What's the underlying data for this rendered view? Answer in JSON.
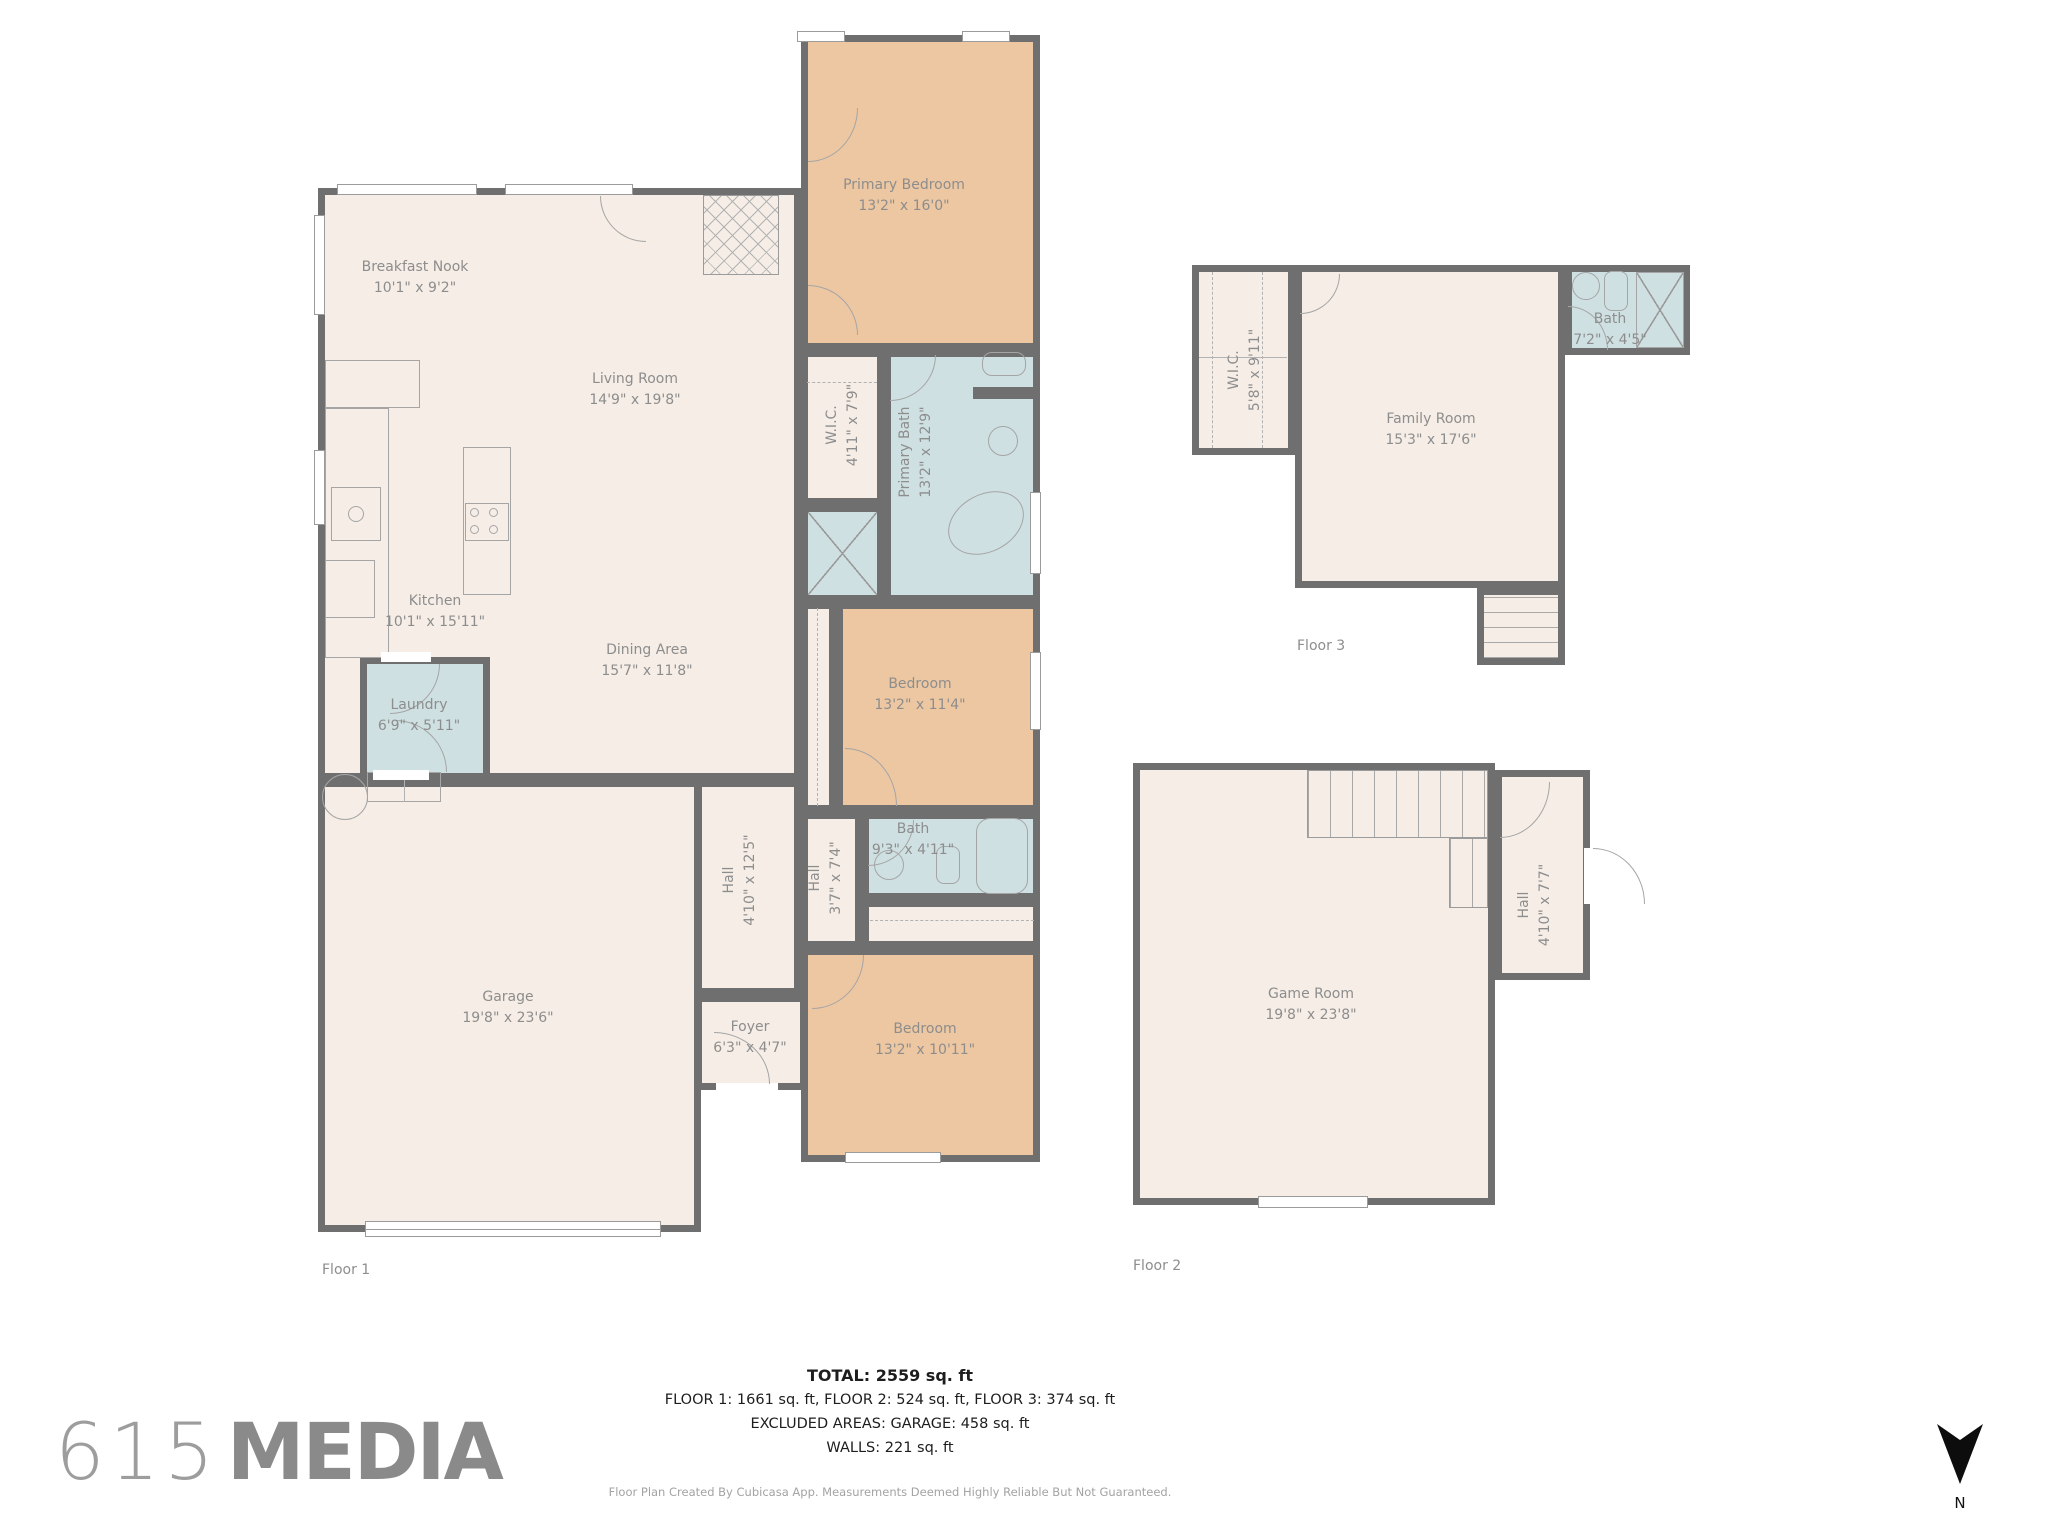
{
  "colors": {
    "wall": "#6f6f6f",
    "floor": "#f5ede6",
    "bedroom": "#ecc7a2",
    "bath": "#cfe0e2",
    "label": "#8d8d8d",
    "fixture": "#a5a5a5",
    "summary_text": "#1d1d1d",
    "muted": "#a3a3a3",
    "logo": "#9d9d9d",
    "logo_bold": "#8a8a8a",
    "north": "#111111"
  },
  "floor1": {
    "label": "Floor 1",
    "rooms": {
      "breakfast_nook": {
        "name": "Breakfast Nook",
        "dims": "10'1\" x 9'2\""
      },
      "living_room": {
        "name": "Living Room",
        "dims": "14'9\" x 19'8\""
      },
      "kitchen": {
        "name": "Kitchen",
        "dims": "10'1\" x 15'11\""
      },
      "dining_area": {
        "name": "Dining Area",
        "dims": "15'7\" x 11'8\""
      },
      "primary_bedroom": {
        "name": "Primary Bedroom",
        "dims": "13'2\" x 16'0\""
      },
      "wic": {
        "name": "W.I.C.",
        "dims": "4'11\" x 7'9\""
      },
      "primary_bath": {
        "name": "Primary Bath",
        "dims": "13'2\" x 12'9\""
      },
      "bedroom_mid": {
        "name": "Bedroom",
        "dims": "13'2\" x 11'4\""
      },
      "bath": {
        "name": "Bath",
        "dims": "9'3\" x 4'11\""
      },
      "hall_small": {
        "name": "Hall",
        "dims": "3'7\" x 7'4\""
      },
      "hall_big": {
        "name": "Hall",
        "dims": "4'10\" x 12'5\""
      },
      "bedroom_bottom": {
        "name": "Bedroom",
        "dims": "13'2\" x 10'11\""
      },
      "foyer": {
        "name": "Foyer",
        "dims": "6'3\" x 4'7\""
      },
      "laundry": {
        "name": "Laundry",
        "dims": "6'9\" x 5'11\""
      },
      "garage": {
        "name": "Garage",
        "dims": "19'8\" x 23'6\""
      }
    }
  },
  "floor2": {
    "label": "Floor 2",
    "rooms": {
      "game_room": {
        "name": "Game Room",
        "dims": "19'8\" x 23'8\""
      },
      "hall": {
        "name": "Hall",
        "dims": "4'10\" x 7'7\""
      }
    }
  },
  "floor3": {
    "label": "Floor 3",
    "rooms": {
      "wic": {
        "name": "W.I.C.",
        "dims": "5'8\" x 9'11\""
      },
      "family_room": {
        "name": "Family Room",
        "dims": "15'3\" x 17'6\""
      },
      "bath": {
        "name": "Bath",
        "dims": "7'2\" x 4'5\""
      }
    }
  },
  "summary": {
    "total": "TOTAL: 2559 sq. ft",
    "floors": "FLOOR 1: 1661 sq. ft, FLOOR 2: 524 sq. ft, FLOOR 3: 374 sq. ft",
    "excluded": "EXCLUDED AREAS: GARAGE: 458 sq. ft",
    "walls": "WALLS: 221 sq. ft",
    "disclaimer": "Floor Plan Created By Cubicasa App. Measurements Deemed Highly Reliable But Not Guaranteed."
  },
  "branding": {
    "logo_number": "615",
    "logo_text": "MEDIA"
  },
  "compass": {
    "label": "N"
  }
}
